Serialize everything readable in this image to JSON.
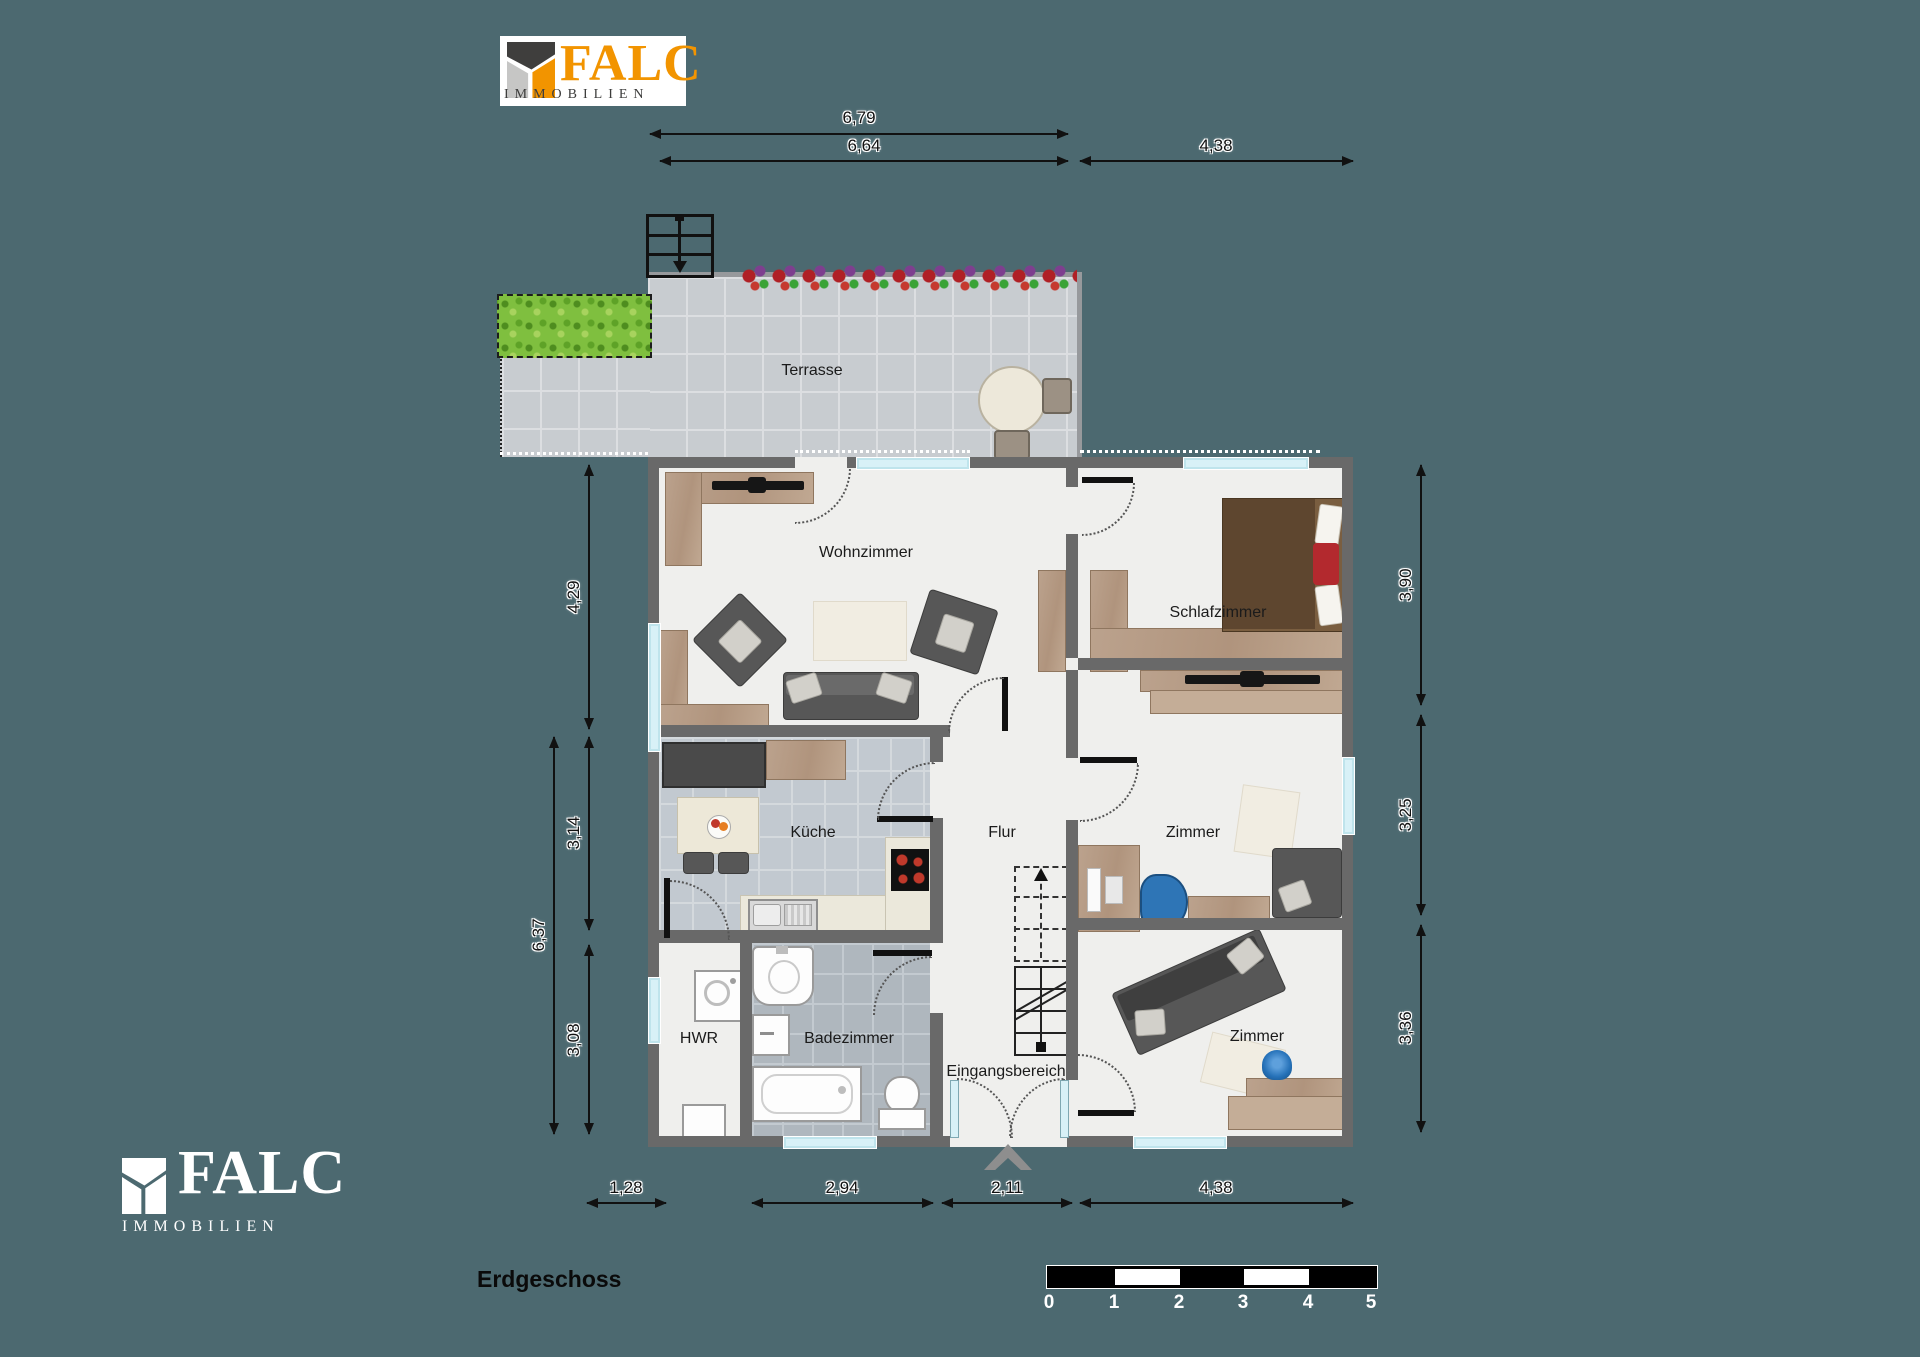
{
  "logo": {
    "brand": "FALC",
    "subtitle": "IMMOBILIEN"
  },
  "floor_label": "Erdgeschoss",
  "rooms": {
    "terrasse": "Terrasse",
    "wohnzimmer": "Wohnzimmer",
    "schlafzimmer": "Schlafzimmer",
    "kueche": "Küche",
    "flur": "Flur",
    "zimmer_mitte": "Zimmer",
    "hwr": "HWR",
    "badezimmer": "Badezimmer",
    "eingangsbereich": "Eingangsbereich",
    "zimmer_unten": "Zimmer"
  },
  "dimensions": {
    "top": [
      "6,79",
      "6,64",
      "4,38"
    ],
    "left": [
      "4,29",
      "3,14",
      "6,37",
      "3,08"
    ],
    "right": [
      "3,90",
      "3,25",
      "3,36"
    ],
    "bottom": [
      "1,28",
      "2,94",
      "2,11",
      "4,38"
    ]
  },
  "scale_bar": {
    "labels": [
      "0",
      "1",
      "2",
      "3",
      "4",
      "5"
    ]
  },
  "colors": {
    "background": "#4C6970",
    "wall": "#696969",
    "floor": "#EFEFED",
    "terrace_tile": "#C8CCD0",
    "kitchen_tile": "#C2C9D0",
    "bath_tile": "#AFB7BE",
    "wood": "#B49B87",
    "logo_orange": "#F29400",
    "logo_gray": "#3D3D3C",
    "accent_red": "#B3292E",
    "accent_blue": "#2E75B6",
    "window_glass": "#D8F1F7"
  }
}
